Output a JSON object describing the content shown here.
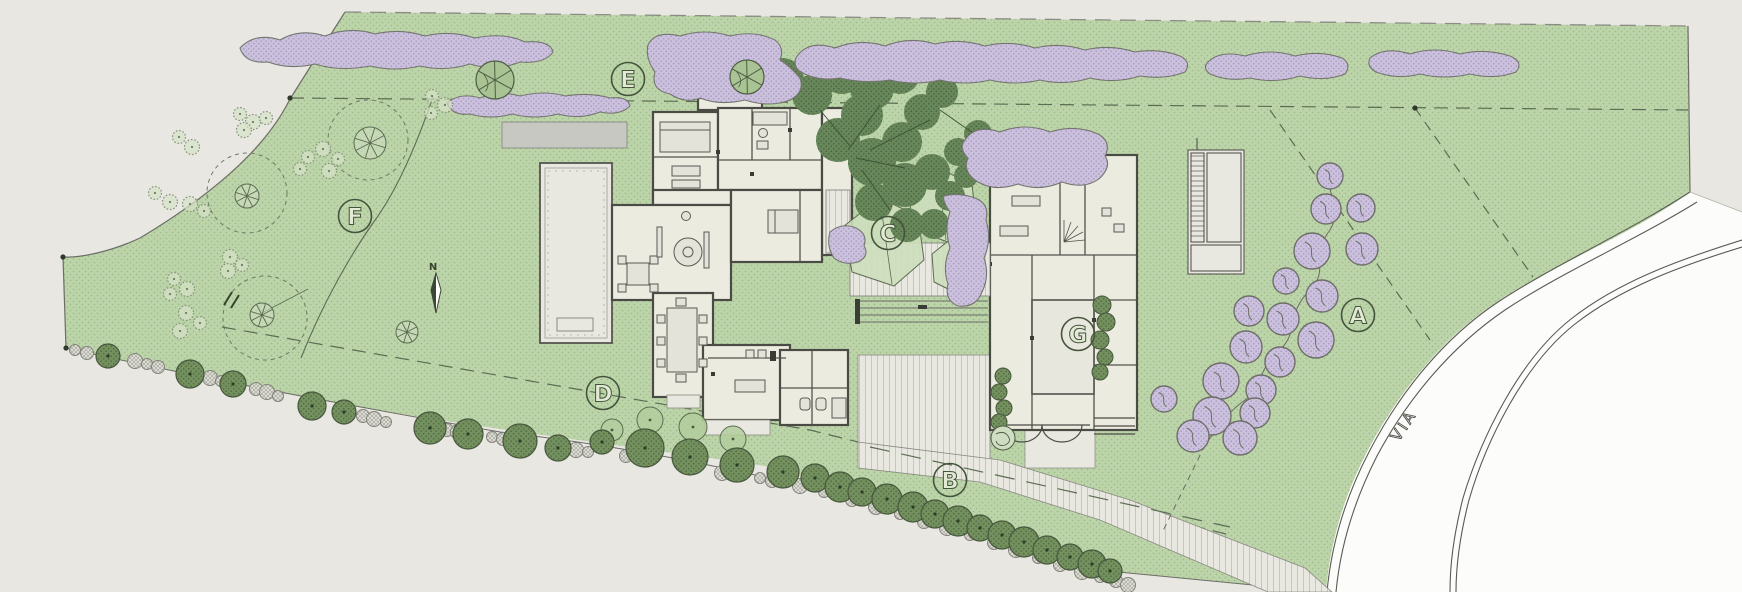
{
  "plan": {
    "zones": [
      {
        "letter": "A"
      },
      {
        "letter": "B"
      },
      {
        "letter": "C"
      },
      {
        "letter": "D"
      },
      {
        "letter": "E"
      },
      {
        "letter": "F"
      },
      {
        "letter": "G"
      }
    ],
    "road_label": "VIA",
    "north_label": "N",
    "colors": {
      "background": "#e8e7e2",
      "lawn": "#bdd4ab",
      "lawn_dot": "#9abe84",
      "shrub_purple": "#cbc1dd",
      "hedge_tree_green": "#73905e",
      "canopy_green": "#68875b",
      "house_fill": "#ecebe0",
      "wall": "#4b4b45",
      "paving": "#e9e8e0",
      "road_white": "#fcfcfa",
      "label_green": "#44543c"
    }
  }
}
